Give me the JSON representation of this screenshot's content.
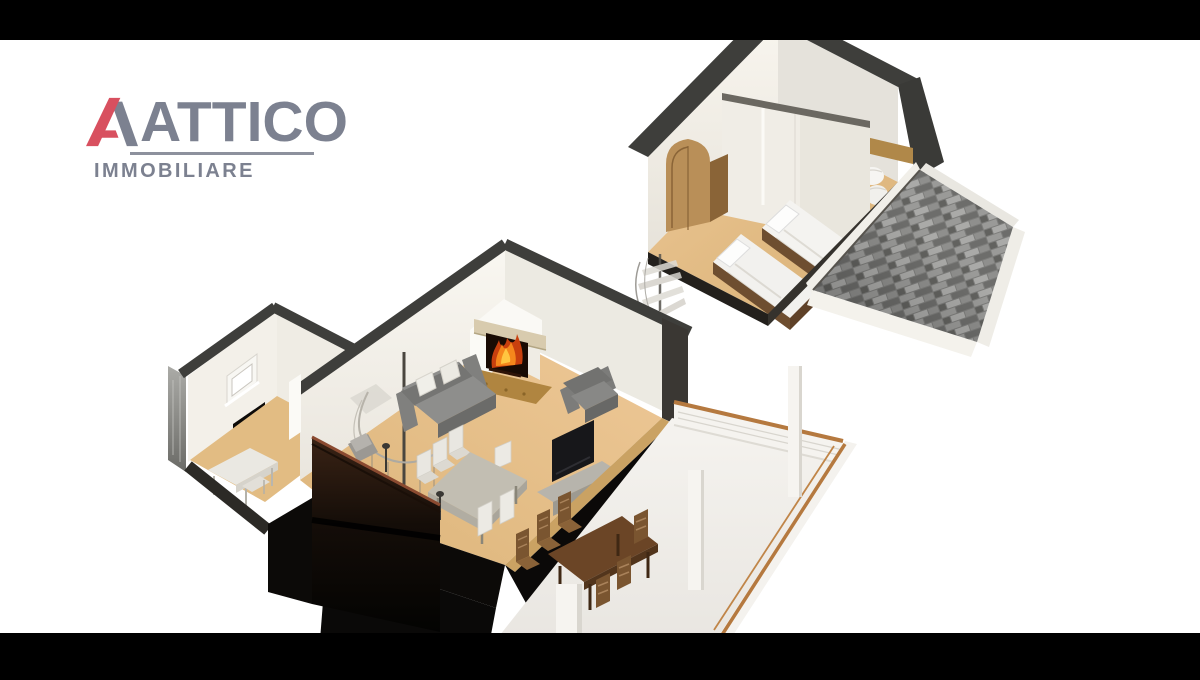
{
  "frame": {
    "width": 1200,
    "height": 680,
    "background": "#ffffff",
    "letterbox_color": "#000000",
    "top_bar_height": 40,
    "bottom_bar_height": 47
  },
  "logo": {
    "title": "ATTICO",
    "subtitle": "IMMOBILIARE",
    "title_color": "#7c8190",
    "accent_color": "#d8505f",
    "underline_color": "#8d919d"
  },
  "scene": {
    "kind": "3d-cutaway-floorplan-render",
    "levels": [
      {
        "name": "upper level",
        "rooms": [
          {
            "name": "bedroom",
            "furniture": [
              "wardrobe",
              "single bed",
              "single bed",
              "partition wall"
            ]
          },
          {
            "name": "second bedroom",
            "furniture": [
              "bed headboard",
              "white linens"
            ]
          }
        ],
        "roof": {
          "material": "gray shingles",
          "fascia": "white"
        }
      },
      {
        "name": "main level",
        "rooms": [
          {
            "name": "study",
            "furniture": [
              "window",
              "dark wall screen",
              "desk",
              "chair"
            ]
          },
          {
            "name": "living dining room",
            "furniture": [
              "corner fireplace with burning fire",
              "gray sofa",
              "2 white throw pillows",
              "gray armchair",
              "gray dining table",
              "6 white chairs",
              "tv",
              "tv stand",
              "2 floor lamps",
              "spiral staircase",
              "dark sloped cut panel"
            ]
          },
          {
            "name": "terrace",
            "furniture": [
              "wood-topped railing",
              "3 white pillars",
              "outdoor wood dining table",
              "6 outdoor chairs"
            ]
          }
        ]
      }
    ],
    "palette": {
      "floor_wood": "#e2bc83",
      "wall_face": "#f5f2ea",
      "wall_cut_band": "#3e3e3b",
      "partition": "#f0ede6",
      "roof_shingle": "#7d7d7b",
      "roof_fascia": "#f1efe9",
      "terrace_floor": "#f0eeea",
      "railing_wood": "#b5793f",
      "sofa": "#7e7e7c",
      "fire": "#f5871c",
      "hearth": "#b08540",
      "dark_panel": "#1a120c",
      "outdoor_wood": "#6b4526",
      "bed_linen": "#f2f1ee",
      "wardrobe": "#b98f58"
    }
  }
}
